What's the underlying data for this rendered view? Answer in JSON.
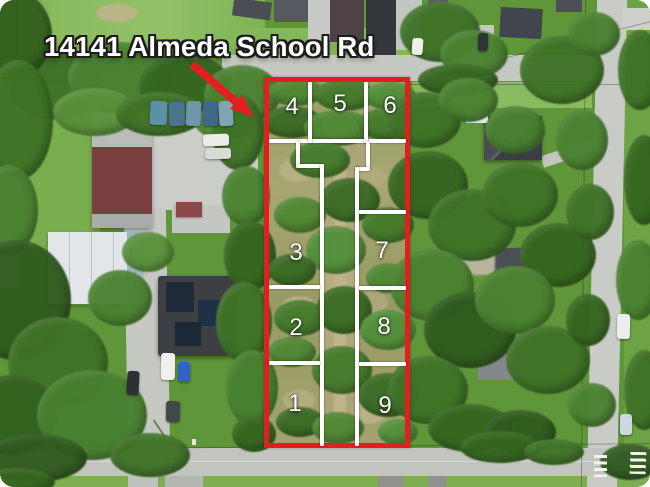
{
  "annotation": {
    "address": "14141 Almeda School Rd",
    "arrow_icon": "red-arrow-pointing-to-parcel"
  },
  "parcel": {
    "boundary_color": "#e41e1e",
    "lot_line_color": "#ffffff",
    "lot_number_color": "#ffffff",
    "lots": [
      {
        "label": "4"
      },
      {
        "label": "5"
      },
      {
        "label": "6"
      },
      {
        "label": "3"
      },
      {
        "label": "7"
      },
      {
        "label": "2"
      },
      {
        "label": "8"
      },
      {
        "label": "1"
      },
      {
        "label": "9"
      }
    ]
  }
}
